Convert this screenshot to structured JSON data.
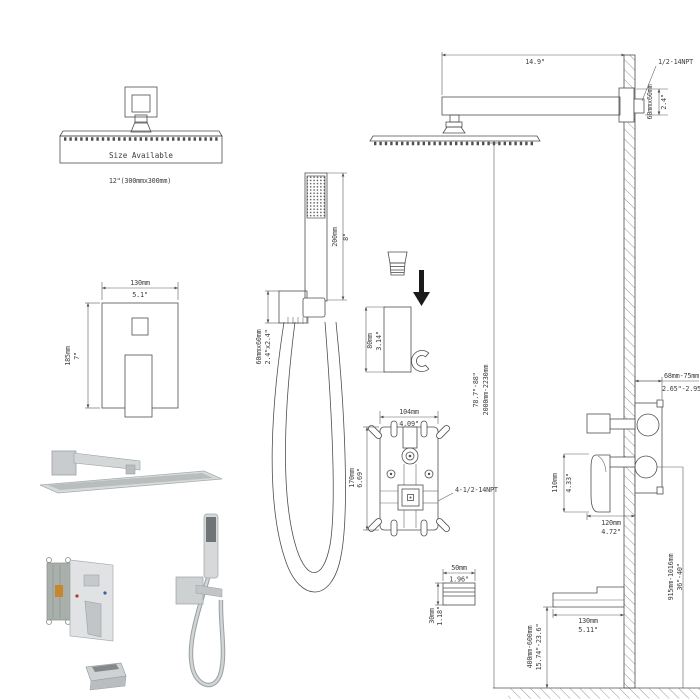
{
  "labels": {
    "size_available": "Size Available",
    "head_size": "12\"(300mmx300mm)",
    "arm_length_in": "14.9\"",
    "arm_thread": "1/2-14NPT",
    "arm_flange_mm": "60mmx60mm",
    "arm_flange_in": "2.4\"",
    "trim_width_mm": "130mm",
    "trim_width_in": "5.1\"",
    "trim_height_mm": "185mm",
    "trim_height_in": "7\"",
    "wand_length_mm": "200mm",
    "wand_length_in": "8\"",
    "holder_mm": "60mmx60mm",
    "holder_in": "2.4\"x2.4\"",
    "bracket_mm": "80mm",
    "bracket_in": "3.14\"",
    "valve_width_mm": "104mm",
    "valve_width_in": "4.09\"",
    "valve_height_mm": "170mm",
    "valve_height_in": "6.69\"",
    "valve_thread": "4-1/2-14NPT",
    "overall_height_mm": "2000mm-2230mm",
    "overall_height_in": "78.7\"-88\"",
    "depth_mm": "68mm-75mm",
    "depth_in": "2.65\"-2.95\"",
    "handle_mm": "110mm",
    "handle_in": "4.33\"",
    "side_width_mm": "120mm",
    "side_width_in": "4.72\"",
    "conn_w_mm": "50mm",
    "conn_w_in": "1.96\"",
    "conn_h_mm": "30mm",
    "conn_h_in": "1.18\"",
    "spout_len_mm": "130mm",
    "spout_len_in": "5.11\"",
    "spout_height_mm": "400mm-600mm",
    "spout_height_in": "15.74\"-23.6\"",
    "floor_height_mm": "915mm-1016mm",
    "floor_height_in": "36\"-40\""
  },
  "colors": {
    "line": "#4f4f4f",
    "background": "#ffffff",
    "metal_light": "#d7dadb",
    "metal_mid": "#c2c5c7",
    "metal_dark": "#84888b",
    "rough_in_box": "#a9b0ac",
    "label_orange": "#c8862a",
    "hot_dot": "#b23b30",
    "cold_dot": "#3a62a8",
    "arrow_black": "#1a1a1a"
  }
}
